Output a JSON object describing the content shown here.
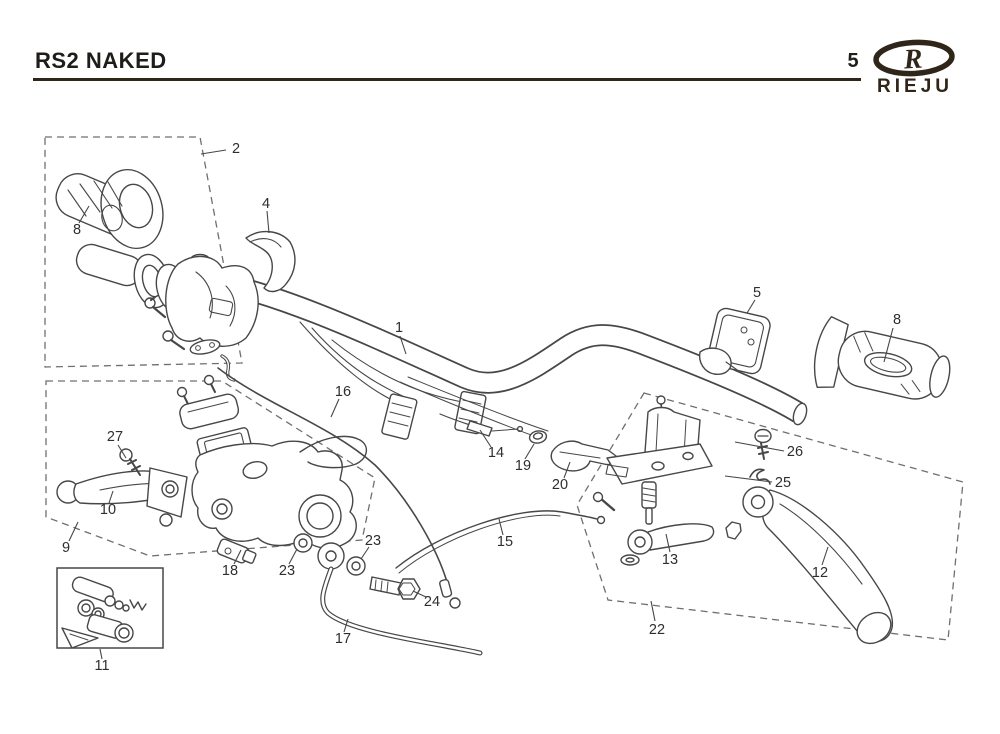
{
  "header": {
    "title": "RS2 NAKED",
    "page_number": "5",
    "brand_name": "RIEJU",
    "brand_letter": "R"
  },
  "colors": {
    "line_art": "#474747",
    "dashed_box": "#6f6f6f",
    "header_rule": "#2f2619",
    "label_text": "#2e2e2e"
  },
  "diagram": {
    "labels": [
      {
        "part": "2",
        "x": 236,
        "y": 149,
        "leader": [
          226,
          150,
          201,
          154
        ]
      },
      {
        "part": "8",
        "x": 77,
        "y": 230,
        "leader": [
          79,
          223,
          89,
          206
        ]
      },
      {
        "part": "4",
        "x": 266,
        "y": 204,
        "leader": [
          267,
          211,
          269,
          233
        ]
      },
      {
        "part": "1",
        "x": 399,
        "y": 328,
        "leader": [
          400,
          336,
          406,
          354
        ]
      },
      {
        "part": "5",
        "x": 757,
        "y": 293,
        "leader": [
          755,
          300,
          747,
          313
        ]
      },
      {
        "part": "8",
        "x": 897,
        "y": 320,
        "leader": [
          893,
          328,
          884,
          362
        ]
      },
      {
        "part": "26",
        "x": 795,
        "y": 452,
        "leader": [
          784,
          451,
          735,
          442
        ]
      },
      {
        "part": "25",
        "x": 783,
        "y": 483,
        "leader": [
          772,
          482,
          725,
          476
        ]
      },
      {
        "part": "27",
        "x": 115,
        "y": 437,
        "leader": [
          118,
          445,
          126,
          458
        ]
      },
      {
        "part": "10",
        "x": 108,
        "y": 510,
        "leader": [
          109,
          503,
          113,
          491
        ]
      },
      {
        "part": "9",
        "x": 66,
        "y": 548,
        "leader": [
          69,
          541,
          78,
          522
        ]
      },
      {
        "part": "16",
        "x": 343,
        "y": 392,
        "leader": [
          339,
          399,
          331,
          417
        ]
      },
      {
        "part": "14",
        "x": 496,
        "y": 453,
        "leader": [
          491,
          447,
          480,
          430
        ]
      },
      {
        "part": "19",
        "x": 523,
        "y": 466,
        "leader": [
          525,
          459,
          534,
          444
        ]
      },
      {
        "part": "20",
        "x": 560,
        "y": 485,
        "leader": [
          564,
          478,
          570,
          462
        ]
      },
      {
        "part": "15",
        "x": 505,
        "y": 542,
        "leader": [
          503,
          535,
          499,
          519
        ]
      },
      {
        "part": "13",
        "x": 670,
        "y": 560,
        "leader": [
          670,
          552,
          666,
          534
        ]
      },
      {
        "part": "12",
        "x": 820,
        "y": 573,
        "leader": [
          822,
          565,
          828,
          547
        ]
      },
      {
        "part": "22",
        "x": 657,
        "y": 630,
        "leader": [
          655,
          621,
          651,
          601
        ]
      },
      {
        "part": "18",
        "x": 230,
        "y": 571,
        "leader": [
          234,
          564,
          241,
          550
        ]
      },
      {
        "part": "23",
        "x": 287,
        "y": 571,
        "leader": [
          289,
          564,
          297,
          549
        ]
      },
      {
        "part": "23",
        "x": 373,
        "y": 541,
        "leader": [
          369,
          547,
          361,
          559
        ]
      },
      {
        "part": "24",
        "x": 432,
        "y": 602,
        "leader": [
          426,
          597,
          413,
          591
        ]
      },
      {
        "part": "17",
        "x": 343,
        "y": 639,
        "leader": [
          344,
          632,
          348,
          619
        ]
      },
      {
        "part": "11",
        "x": 102,
        "y": 666,
        "leader": [
          102,
          659,
          100,
          649
        ]
      }
    ]
  }
}
